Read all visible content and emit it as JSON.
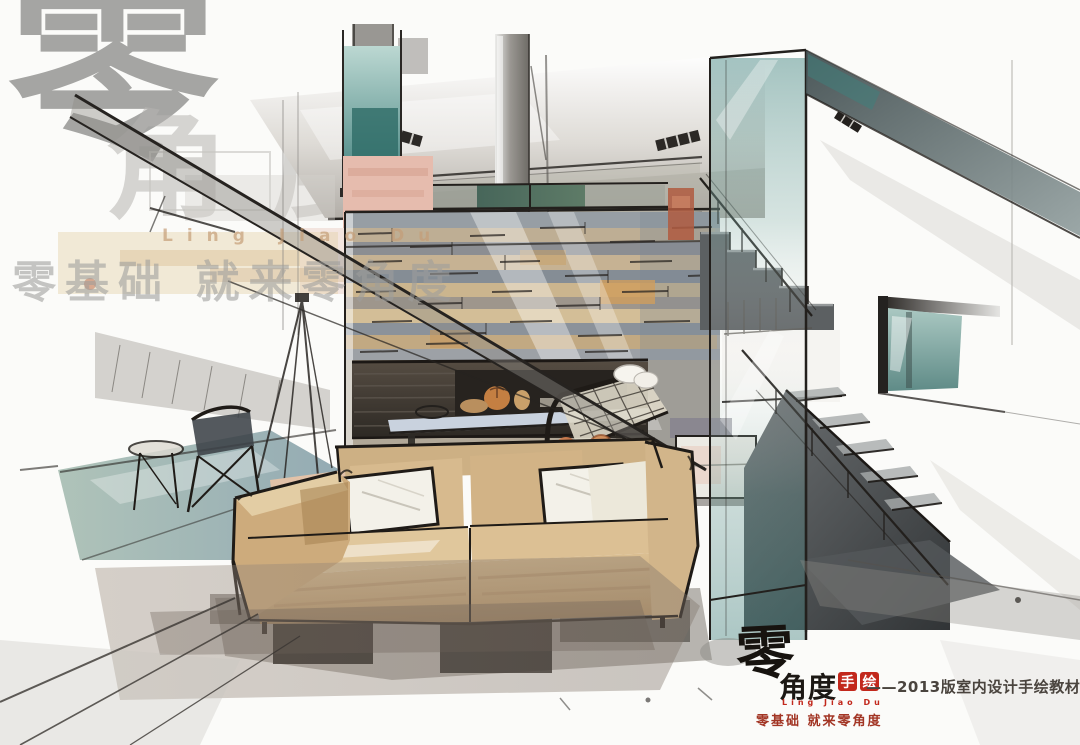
{
  "artwork": {
    "subject": "Hand-drawn marker rendering of a loft living room: stone fireplace wall, tan sofa with white pillows, glass-screened staircase, metal lounge chair"
  },
  "watermark": {
    "glyph": "零",
    "glyph_secondary": "角度",
    "latin": "Ling Jiao Du",
    "slogan": "零基础  就来零角度",
    "color": "#9e9e9c"
  },
  "logo": {
    "glyph": "零",
    "brand": "角度",
    "seal_chars": [
      "手",
      "绘"
    ],
    "latin": "Ling Jiao Du",
    "caption": "——2013版室内设计手绘教材",
    "slogan": "零基础  就来零角度",
    "red": "#c2281c"
  },
  "palette": {
    "paper": "#fbfbf9",
    "ink": "#262320",
    "teal_glass": "#4a8a86",
    "salmon_wall": "#e6bcae",
    "stone_tan": "#c3a87e",
    "stone_slate": "#8a929c",
    "transom_green": "#50705f",
    "sofa_tan": "#d4b488",
    "pillow_white": "#f3f0e8",
    "accent_rust": "#b75f3e",
    "watermark_gray": "#9e9e9c",
    "logo_red": "#c2281c"
  }
}
